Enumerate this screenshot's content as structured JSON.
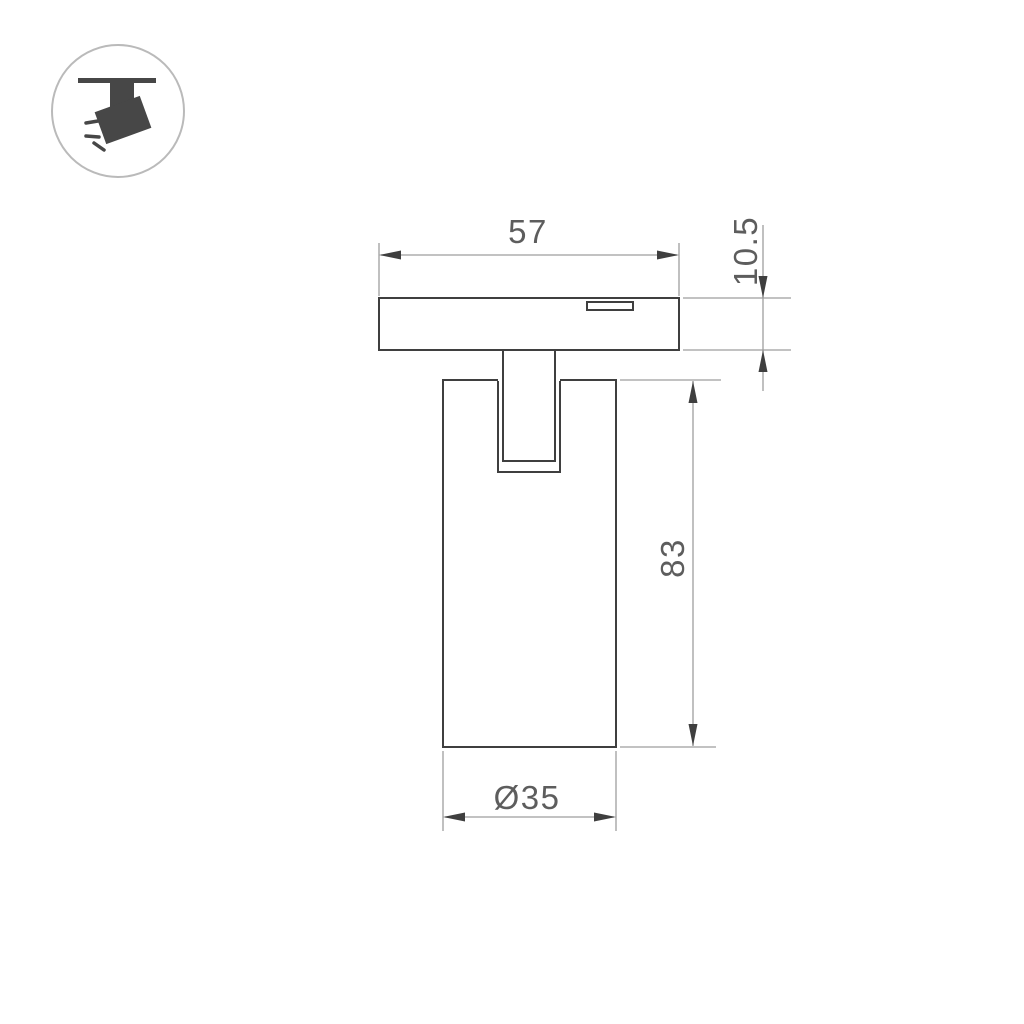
{
  "colors": {
    "background": "#ffffff",
    "outline": "#3f3f3f",
    "dim_line": "#9e9e9e",
    "dim_text": "#5d5d5d",
    "icon_glyph": "#474747",
    "icon_ring": "#bababa"
  },
  "badge": {
    "icon": "track-spotlight-icon"
  },
  "drawing": {
    "type": "diagram",
    "view": "technical dimension drawing, side elevation",
    "dimensions": {
      "plate_width": "57",
      "plate_height": "10.5",
      "body_height": "83",
      "body_diameter": "Ø35"
    }
  }
}
